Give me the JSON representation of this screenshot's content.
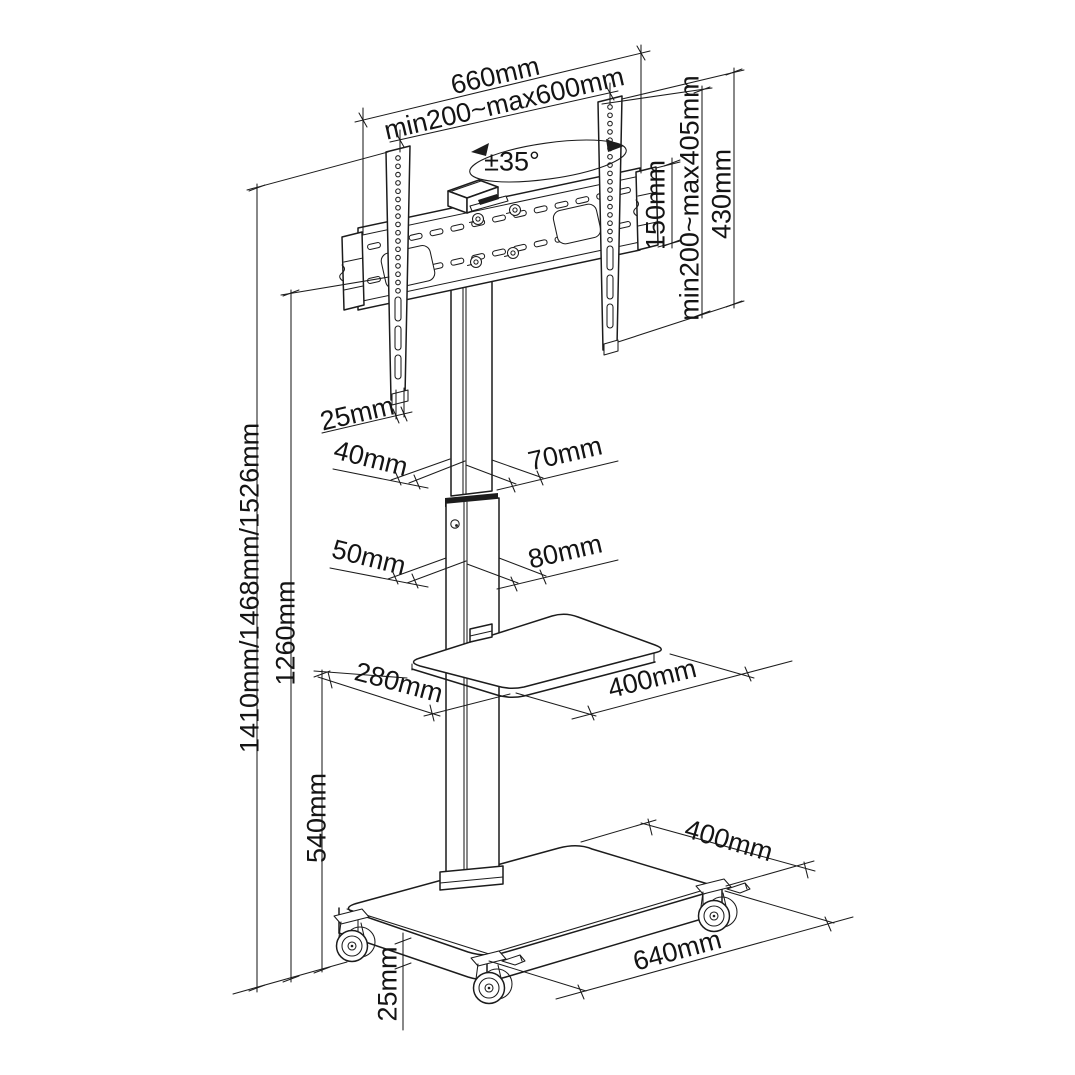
{
  "figure": {
    "kind": "technical dimension drawing",
    "subject": "mobile TV floor stand with swivel mount bracket, shelf and wheeled base",
    "line_color": "#1c1c1c",
    "background": "#ffffff"
  },
  "labels": {
    "plate_width": "660mm",
    "vesa_width": "min200~max600mm",
    "swivel_angle": "±35°",
    "adapter_height": "150mm",
    "vesa_height": "min200~max405mm",
    "bracket_height": "430mm",
    "bracket_offset": "25mm",
    "column_upper_depth": "40mm",
    "column_upper_width": "70mm",
    "column_lower_depth": "50mm",
    "column_lower_width": "80mm",
    "shelf_depth": "280mm",
    "shelf_width": "400mm",
    "overall_heights": "1410mm/1468mm/1526mm",
    "column_height": "1260mm",
    "shelf_mount_height": "540mm",
    "ground_clearance": "25mm",
    "base_depth": "400mm",
    "base_width": "640mm"
  }
}
